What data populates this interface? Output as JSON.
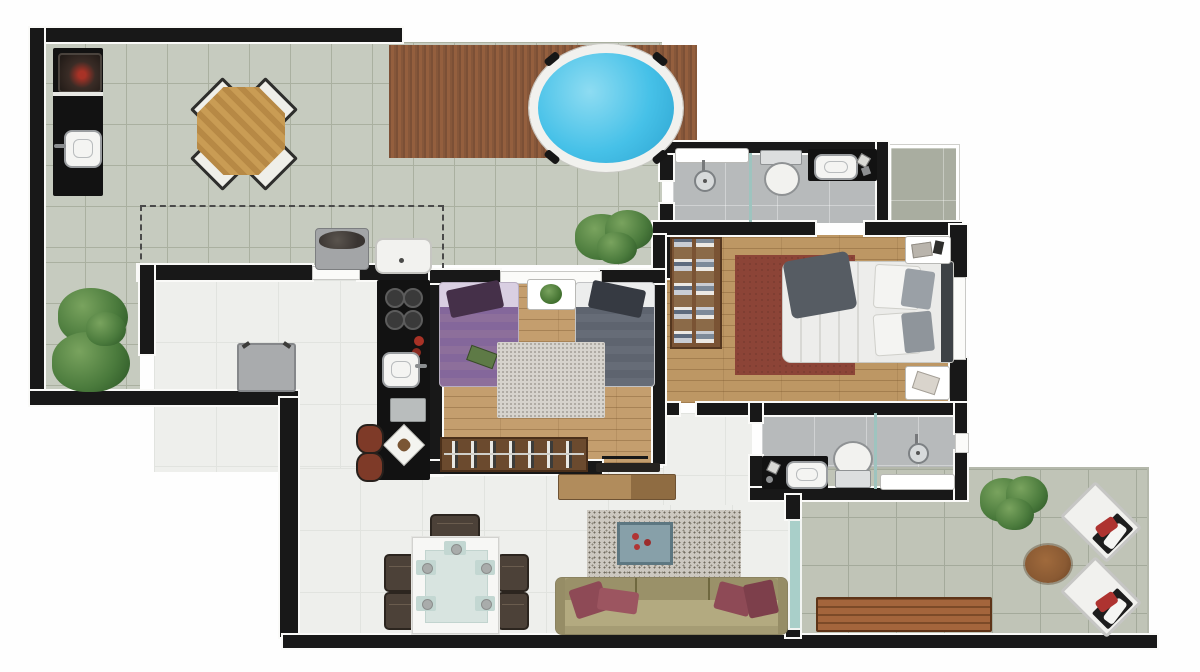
{
  "meta": {
    "kind": "apartment-floor-plan",
    "view": "top-down-render",
    "visible_text": "none"
  },
  "palette": {
    "wall": "#181818",
    "terrace_tile": "#c6cbbf",
    "terrace_grout": "#aab0a0",
    "deck_wood": "#86573a",
    "pool_water": "#46c1e8",
    "interior_floor": "#eeefec",
    "bedroom_wood": "#c49e6e",
    "bathroom_tile": "#b7babb",
    "master_rug": "#8c4437",
    "twin_rug": "#d6d3cd",
    "living_rug": "#ccc8c0",
    "sofa": "#a59c74",
    "accent_pillow": "#8e4a56",
    "purple_bed": "#8d6f9b",
    "grey_bed": "#666c77",
    "glass": "#a9cfc9",
    "plant_green": "#4a7a3c",
    "counter_black": "#121212",
    "stool_red": "#7e3a28",
    "bench_wood": "#9c5f38",
    "grill_red": "#a83226"
  },
  "labels": {
    "floor_plan": "Apartment floor plan",
    "terrace": "Terrace",
    "terrace_strip": "Terrace side strip",
    "wood_deck": "Wood deck",
    "hot_tub": "Round pool / hot tub",
    "barbecue_counter": "Barbecue counter",
    "barbecue_grill": "Charcoal grill",
    "outdoor_sink": "Outdoor sink",
    "outdoor_table": "Octagonal outdoor table",
    "outdoor_chair": "Outdoor chair",
    "covered_area_outline": "Covered area dashed outline",
    "washing_machine": "Washing machine",
    "laundry_tub": "Laundry tub",
    "planter": "Plant",
    "bathroom1": "Bathroom 1",
    "shower": "Shower",
    "shower_partition": "Glass shower partition",
    "toilet": "Toilet",
    "vanity": "Vanity with sink",
    "wall_bench": "Bench / shelf",
    "service_area": "Service area",
    "master_bedroom": "Master bedroom",
    "wardrobe": "Wardrobe shelves",
    "master_bed": "Double bed",
    "rug": "Rug",
    "nightstand": "Nightstand",
    "bathroom2": "Bathroom 2",
    "shower_bench": "Shower bench",
    "twin_bedroom": "Second bedroom",
    "single_bed_purple": "Single bed (purple)",
    "single_bed_grey": "Single bed (grey)",
    "plant_mat": "Plant mat",
    "shoe_rack": "Shoe rack",
    "door_leaf": "Door leaf",
    "kitchen": "Kitchen",
    "kitchen_counter": "Kitchen counter",
    "cooktop": "Cooktop",
    "kitchen_sink": "Kitchen sink",
    "refrigerator": "Refrigerator / cabinet",
    "bar_stool": "Bar stool",
    "dining_area": "Dining area",
    "dining_table": "Dining table",
    "dining_chair": "Dining chair",
    "living_room": "Living room",
    "tv_sideboard": "TV sideboard",
    "tv": "TV",
    "coffee_table": "Coffee table",
    "sofa": "Sofa",
    "glass_door": "Glass door",
    "hallway": "Hallway",
    "window": "Window",
    "balcony": "Balcony terrace",
    "lounger": "Sun lounger",
    "side_table": "Round side table",
    "garden_bench": "Garden bench"
  }
}
